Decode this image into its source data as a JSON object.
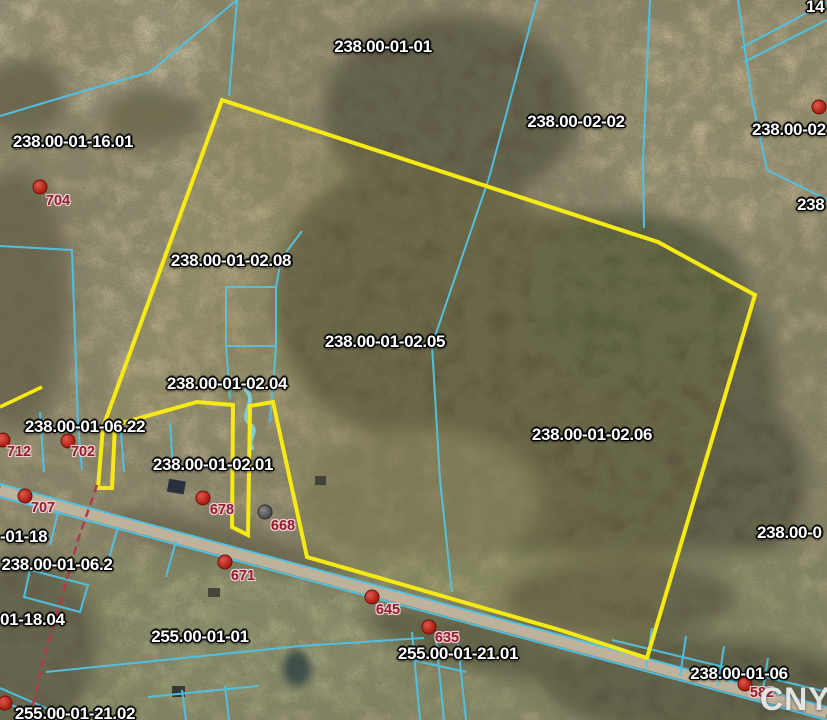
{
  "map": {
    "watermark": "CNYIS",
    "colors": {
      "parcel_line": "#4fc3e8",
      "selected_parcel": "#f6ea14",
      "parcel_label": "#ffffff",
      "house_label": "#8e1f2c",
      "address_dot": "#b02418",
      "unknown_address_dot": "#545454",
      "municipal_dashed_line": "#b13a4a"
    },
    "parcel_labels": [
      {
        "text": "238.00-01-01",
        "x": 383,
        "y": 47,
        "anchor": "center"
      },
      {
        "text": "238.00-02-02",
        "x": 576,
        "y": 122,
        "anchor": "center"
      },
      {
        "text": "238.00-02",
        "x": 752,
        "y": 130,
        "anchor": "left"
      },
      {
        "text": "238",
        "x": 797,
        "y": 205,
        "anchor": "left"
      },
      {
        "text": "14",
        "x": 806,
        "y": 7,
        "anchor": "left"
      },
      {
        "text": "238.00-01-16.01",
        "x": 73,
        "y": 142,
        "anchor": "center"
      },
      {
        "text": "238.00-01-02.08",
        "x": 231,
        "y": 261,
        "anchor": "center"
      },
      {
        "text": "238.00-01-02.05",
        "x": 385,
        "y": 342,
        "anchor": "center"
      },
      {
        "text": "238.00-01-02.04",
        "x": 227,
        "y": 384,
        "anchor": "center"
      },
      {
        "text": "238.00-01-06.22",
        "x": 85,
        "y": 427,
        "anchor": "center"
      },
      {
        "text": "238.00-01-02.01",
        "x": 213,
        "y": 465,
        "anchor": "center"
      },
      {
        "text": "238.00-01-02.06",
        "x": 592,
        "y": 435,
        "anchor": "center"
      },
      {
        "text": "-01-18",
        "x": 0,
        "y": 537,
        "anchor": "left"
      },
      {
        "text": "238.00-01-06.2",
        "x": 57,
        "y": 565,
        "anchor": "center"
      },
      {
        "text": "01-18.04",
        "x": 0,
        "y": 620,
        "anchor": "left"
      },
      {
        "text": "255.00-01-01",
        "x": 200,
        "y": 637,
        "anchor": "center"
      },
      {
        "text": "255.00-01-21.01",
        "x": 458,
        "y": 654,
        "anchor": "center"
      },
      {
        "text": "238.00-01-06",
        "x": 739,
        "y": 674,
        "anchor": "center"
      },
      {
        "text": "238.00-0",
        "x": 757,
        "y": 533,
        "anchor": "left"
      },
      {
        "text": "255.00-01-21.02",
        "x": 75,
        "y": 714,
        "anchor": "center"
      }
    ],
    "house_markers": [
      {
        "number": "704",
        "x": 58,
        "y": 201,
        "dot": {
          "x": 40,
          "y": 187
        },
        "dot_color": "red"
      },
      {
        "number": "712",
        "x": 19,
        "y": 452,
        "dot": {
          "x": 3,
          "y": 440
        },
        "dot_color": "red"
      },
      {
        "number": "702",
        "x": 83,
        "y": 452,
        "dot": {
          "x": 68,
          "y": 441
        },
        "dot_color": "red"
      },
      {
        "number": "707",
        "x": 43,
        "y": 508,
        "dot": {
          "x": 25,
          "y": 496
        },
        "dot_color": "red"
      },
      {
        "number": "678",
        "x": 222,
        "y": 510,
        "dot": {
          "x": 203,
          "y": 498
        },
        "dot_color": "red"
      },
      {
        "number": "668",
        "x": 283,
        "y": 526,
        "dot": {
          "x": 265,
          "y": 512
        },
        "dot_color": "gray"
      },
      {
        "number": "671",
        "x": 243,
        "y": 576,
        "dot": {
          "x": 225,
          "y": 562
        },
        "dot_color": "red"
      },
      {
        "number": "645",
        "x": 388,
        "y": 610,
        "dot": {
          "x": 372,
          "y": 597
        },
        "dot_color": "red"
      },
      {
        "number": "635",
        "x": 447,
        "y": 638,
        "dot": {
          "x": 429,
          "y": 627
        },
        "dot_color": "red"
      },
      {
        "number": "582",
        "x": 762,
        "y": 693,
        "dot": {
          "x": 745,
          "y": 684
        },
        "dot_color": "red"
      }
    ],
    "extra_dots": [
      {
        "x": 819,
        "y": 107,
        "dot_color": "red"
      },
      {
        "x": 5,
        "y": 703,
        "dot_color": "red"
      }
    ]
  }
}
